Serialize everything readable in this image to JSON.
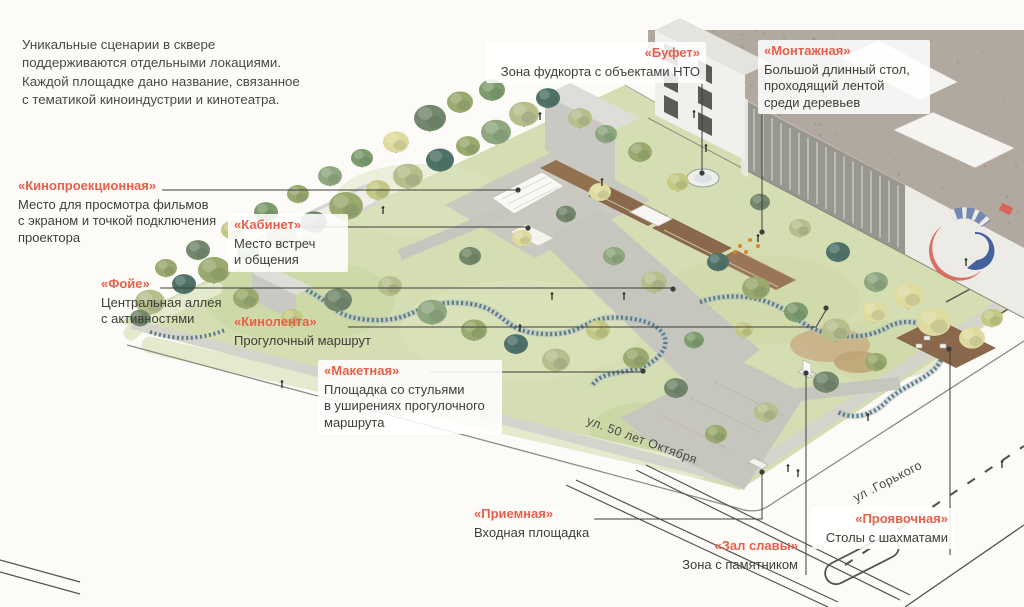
{
  "page": {
    "background": "#FCFBF8",
    "accent_color": "#E8604C",
    "text_color": "#3F3E3A"
  },
  "intro": {
    "text": "Уникальные сценарии в сквере\nподдерживаются отдельными локациями.\nКаждой площадке дано название, связанное\nс тематикой киноиндустрии и кинотеатра."
  },
  "legend_labels": [
    {
      "id": "kinoproekcionnaya",
      "title": "«Кинопроекционная»",
      "description": "Место для просмотра фильмов\nс экраном и точкой подключения\nпроектора"
    },
    {
      "id": "kabinet",
      "title": "«Кабинет»",
      "description": "Место встреч\nи общения"
    },
    {
      "id": "foje",
      "title": "«Фойе»",
      "description": "Центральная аллея\nс активностями"
    },
    {
      "id": "kinolenta",
      "title": "«Кинолента»",
      "description": "Прогулочный маршрут"
    },
    {
      "id": "maketnaya",
      "title": "«Макетная»",
      "description": "Площадка со стульями\nв уширениях прогулочного\nмаршрута"
    },
    {
      "id": "bufet",
      "title": "«Буфет»",
      "description": "Зона фудкорта  с объектами НТО"
    },
    {
      "id": "montazhnaya",
      "title": "«Монтажная»",
      "description": "Большой длинный стол,\nпроходящий лентой\nсреди деревьев"
    },
    {
      "id": "priemnaya",
      "title": "«Приемная»",
      "description": "Входная площадка"
    },
    {
      "id": "zal_slavy",
      "title": "«Зал славы»",
      "description": "Зона с памятником"
    },
    {
      "id": "proyavochnaya",
      "title": "«Проявочная»",
      "description": "Столы с шахматами"
    }
  ],
  "streets": [
    {
      "name": "ул. 50 лет Октября"
    },
    {
      "name": "ул .Горького"
    }
  ]
}
